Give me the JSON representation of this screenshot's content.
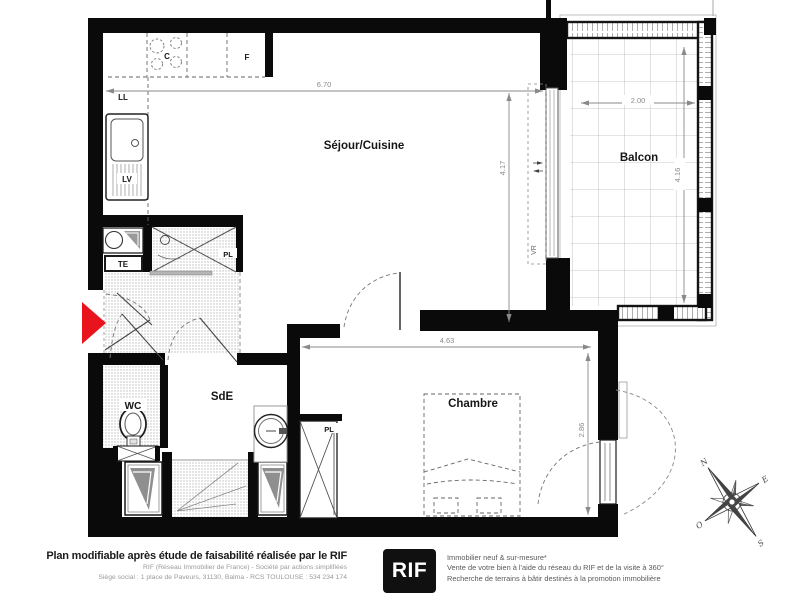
{
  "plan": {
    "rooms": {
      "sejour": {
        "label": "Séjour/Cuisine"
      },
      "balcon": {
        "label": "Balcon"
      },
      "chambre": {
        "label": "Chambre"
      },
      "sde": {
        "label": "SdE"
      },
      "wc": {
        "label": "WC"
      }
    },
    "fixtures": {
      "ll": "LL",
      "lv": "LV",
      "cooktop": "C",
      "fridge": "F",
      "te": "TE",
      "pl_bath": "PL",
      "pl_chambre": "PL",
      "vr": "VR"
    },
    "dimensions": {
      "sejour_width": "6.70",
      "sejour_height": "4.17",
      "balcon_width": "2.00",
      "balcon_height": "4.16",
      "chambre_width": "4.63",
      "chambre_height": "2.86"
    },
    "compass": {
      "n": "N",
      "e": "E",
      "s": "S",
      "o": "O"
    },
    "colors": {
      "wall": "#0a0a0a",
      "entry_arrow": "#e8131c",
      "dim_text": "#8a8a8a",
      "hatch_dot": "#9b9b9b",
      "fixture_gray": "#8f8f8f"
    }
  },
  "footer": {
    "title": "Plan modifiable après étude de faisabilité réalisée par le RIF",
    "line1": "RIF (Réseau Immobilier de France) - Société par actions simplifiées",
    "line2": "Siège social : 1 place de Paveurs, 31130, Balma - RCS TOULOUSE : 534 234 174",
    "logo_text": "RIF",
    "services": [
      "Immobilier neuf & sur-mesure*",
      "Vente de votre bien à l'aide du réseau du RIF et de la visite à 360°",
      "Recherche de terrains à bâtir destinés à la promotion immobilière"
    ]
  }
}
